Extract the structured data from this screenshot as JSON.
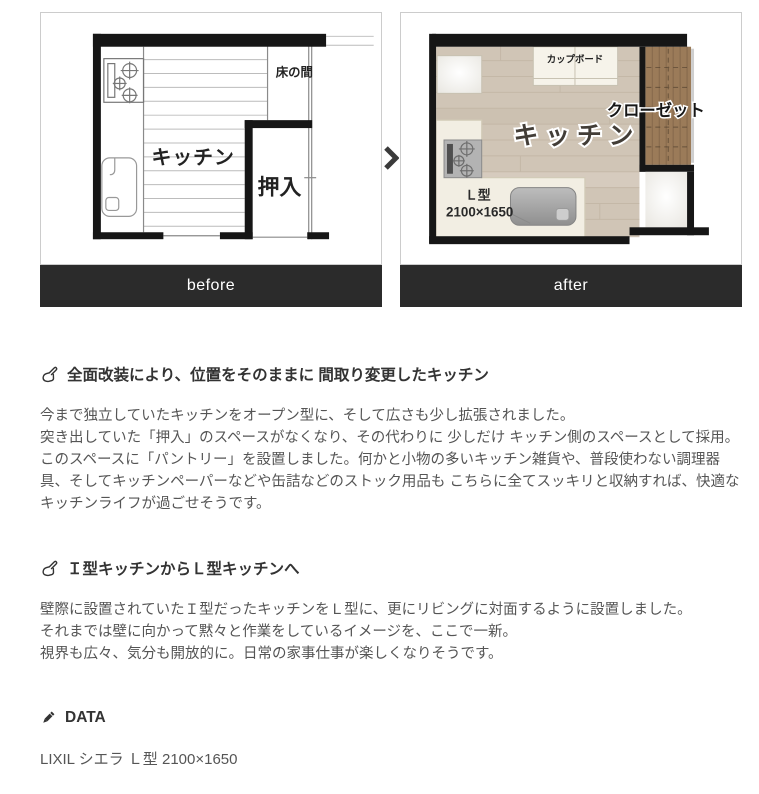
{
  "compare": {
    "before": {
      "bar_label": "before",
      "labels": {
        "kitchen": "キッチン",
        "oshiire": "押入",
        "tokonoma": "床の間"
      }
    },
    "after": {
      "bar_label": "after",
      "labels": {
        "kitchen": "キッチン",
        "cupboard": "カップボード",
        "closet": "クローゼット",
        "layout_type": "Ｌ型",
        "layout_size": "2100×1650"
      }
    }
  },
  "sections": [
    {
      "heading": "全面改装により、位置をそのままに 間取り変更したキッチン",
      "body": "今まで独立していたキッチンをオープン型に、そして広さも少し拡張されました。\n突き出していた「押入」のスペースがなくなり、その代わりに 少しだけ キッチン側のスペースとして採用。\nこのスペースに「パントリー」を設置しました。何かと小物の多いキッチン雑貨や、普段使わない調理器具、そしてキッチンペーパーなどや缶詰などのストック用品も こちらに全てスッキリと収納すれば、快適なキッチンライフが過ごせそうです。"
    },
    {
      "heading": "Ｉ型キッチンからＬ型キッチンへ",
      "body": "壁際に設置されていたＩ型だったキッチンをＬ型に、更にリビングに対面するように設置しました。\nそれまでは壁に向かって黙々と作業をしているイメージを、ここで一新。\n視界も広々、気分も開放的に。日常の家事仕事が楽しくなりそうです。"
    }
  ],
  "data_section": {
    "heading": "DATA",
    "value": "LIXIL シエラ Ｌ型 2100×1650"
  },
  "colors": {
    "bar_bg": "#2b2b2b",
    "bar_text": "#ffffff",
    "heading_text": "#333333",
    "body_text": "#555555",
    "panel_border": "#cccccc",
    "wall": "#161616",
    "wood_floor": "#d0c5b6",
    "closet_wood": "#9b7b59",
    "counter": "#f2eee3"
  }
}
